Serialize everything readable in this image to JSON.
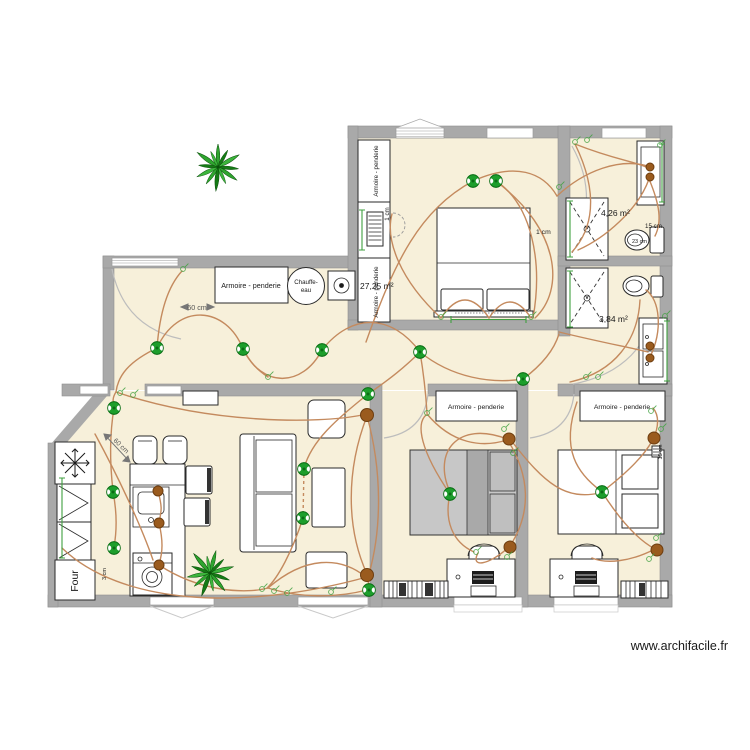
{
  "watermark": "www.archifacile.fr",
  "labels": {
    "wardrobe": "Armoire - penderie",
    "water_heater_line1": "Chauffe-",
    "water_heater_line2": "eau",
    "oven": "Four"
  },
  "areas": {
    "living": "27,25 m²",
    "bathroom_top": "4,26 m²",
    "bathroom_bottom": "3,84 m²"
  },
  "measurements": {
    "one_cm": "1 cm",
    "fifteen_cm": "15 cm",
    "twenty_three_cm": "23 cm",
    "sixty_cm": "60 cm",
    "three_cm": "3 cm"
  },
  "colors": {
    "room_fill": "#F7F0DA",
    "wall": "#A9A9A9",
    "wire": "#C48A5E",
    "light_green": "#1D9E2C",
    "outlet_brown": "#9A5B1E",
    "measure_green": "#3FA03F",
    "plant_green": "#2FA52F"
  },
  "icons": {
    "ceiling_light": "green-dot-target",
    "wall_switch": "green-circle-tick",
    "power_outlet": "brown-dot",
    "plant": "spiky-plant",
    "fridge": "snowflake",
    "shower": "x-cross-square",
    "water_heater": "circle",
    "spotlight": "circle-dot"
  }
}
